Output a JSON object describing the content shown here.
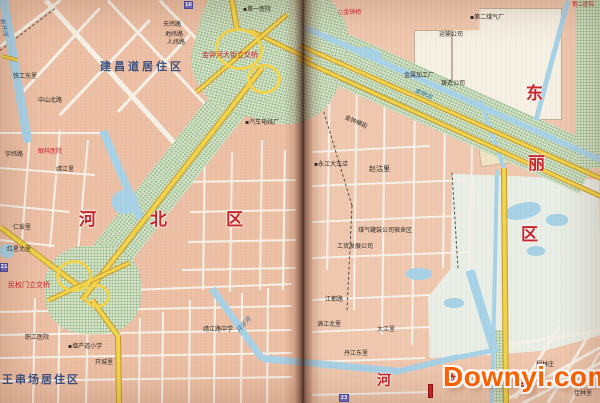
{
  "meta": {
    "description": "Scanned two-page atlas spread of a Tianjin city map showing Hebei District, Dongli District and Hedong District with Jinzhonghe Street interchanges, canals and residential areas",
    "watermark": {
      "text": "Downyi.com"
    }
  },
  "palette": {
    "map_pink": "#edc0a5",
    "street_white": "#f7f2e9",
    "water_blue": "#a9d2e6",
    "highway_yellow": "#f1d44e",
    "highway_edge": "#c19a3a",
    "park_green": "#d6e3ca",
    "park_green_dot": "#96bb8e",
    "district_red": "#c5232b",
    "residential_navy": "#3c5080",
    "label_ink": "#2f2b26",
    "water_label_blue": "#2b6b9c",
    "pale_field": "#e9efe6",
    "industrial_white": "#f6f1e4",
    "watermark_orange": "#ff6400",
    "marker_blue": "#6a6ac2",
    "marker_red": "#c5232b"
  },
  "shapes": {
    "under": [
      {
        "n": "pale-field-area",
        "x": 428,
        "y": 170,
        "w": 173,
        "h": 190,
        "cls": "pale",
        "clip": "polygon(14% 2%, 99% 5%, 100% 87%, 68% 95%, 42% 97%, 1% 99%, 0 67%, 13% 52%)"
      },
      {
        "n": "industrial-block-a",
        "x": 452,
        "y": 8,
        "w": 110,
        "h": 112,
        "cls": "white",
        "clip": "polygon(0 20%, 25% 20%, 25% 0, 100% 0, 100% 100%, 0 100%)"
      },
      {
        "n": "industrial-block-b",
        "x": 414,
        "y": 30,
        "w": 38,
        "h": 58,
        "cls": "white"
      },
      {
        "n": "industrial-block-c",
        "x": 478,
        "y": 126,
        "w": 50,
        "h": 38,
        "cls": "cream",
        "rot": -8
      }
    ],
    "streets": [
      [
        46,
        0,
        183,
        152,
        4.5
      ],
      [
        108,
        0,
        213,
        112,
        2.5
      ],
      [
        160,
        0,
        242,
        86,
        2.5
      ],
      [
        0,
        46,
        60,
        0,
        2.5
      ],
      [
        100,
        8,
        20,
        95,
        2.5
      ],
      [
        150,
        20,
        60,
        115,
        2.5
      ],
      [
        190,
        35,
        118,
        112,
        2.5
      ],
      [
        0,
        133,
        100,
        133,
        2
      ],
      [
        30,
        135,
        22,
        240,
        2
      ],
      [
        60,
        130,
        50,
        248,
        2
      ],
      [
        88,
        140,
        78,
        252,
        2
      ],
      [
        0,
        168,
        95,
        175,
        2
      ],
      [
        0,
        205,
        70,
        212,
        2
      ],
      [
        0,
        240,
        55,
        246,
        2
      ],
      [
        35,
        298,
        33,
        403,
        2
      ],
      [
        60,
        288,
        58,
        403,
        2
      ],
      [
        88,
        300,
        86,
        403,
        2
      ],
      [
        140,
        318,
        139,
        403,
        2
      ],
      [
        163,
        312,
        162,
        403,
        2
      ],
      [
        190,
        300,
        189,
        403,
        2
      ],
      [
        215,
        298,
        214,
        403,
        2
      ],
      [
        242,
        293,
        241,
        403,
        2
      ],
      [
        268,
        288,
        267,
        403,
        2
      ],
      [
        0,
        312,
        292,
        306,
        2
      ],
      [
        0,
        335,
        292,
        330,
        2
      ],
      [
        0,
        358,
        292,
        353,
        2
      ],
      [
        0,
        381,
        292,
        377,
        2
      ],
      [
        130,
        290,
        292,
        284,
        2
      ],
      [
        205,
        140,
        203,
        290,
        2
      ],
      [
        232,
        152,
        230,
        292,
        2
      ],
      [
        262,
        140,
        260,
        290,
        2
      ],
      [
        285,
        150,
        283,
        290,
        2
      ],
      [
        185,
        182,
        296,
        180,
        2
      ],
      [
        190,
        212,
        296,
        210,
        2
      ],
      [
        188,
        242,
        296,
        240,
        2
      ],
      [
        182,
        270,
        296,
        268,
        2
      ],
      [
        330,
        62,
        327,
        270,
        2
      ],
      [
        357,
        68,
        354,
        310,
        2
      ],
      [
        385,
        75,
        382,
        335,
        2
      ],
      [
        415,
        98,
        412,
        345,
        2
      ],
      [
        445,
        122,
        443,
        268,
        2
      ],
      [
        472,
        145,
        470,
        268,
        2
      ],
      [
        312,
        152,
        430,
        146,
        2
      ],
      [
        312,
        186,
        468,
        180,
        2
      ],
      [
        312,
        222,
        455,
        216,
        2
      ],
      [
        312,
        258,
        470,
        252,
        2
      ],
      [
        312,
        300,
        430,
        295,
        2
      ],
      [
        312,
        332,
        430,
        327,
        2
      ],
      [
        312,
        362,
        425,
        358,
        2
      ],
      [
        312,
        395,
        430,
        392,
        2
      ],
      [
        505,
        400,
        600,
        347,
        3
      ],
      [
        522,
        403,
        601,
        362,
        2.5
      ],
      [
        505,
        345,
        600,
        330,
        2.5
      ],
      [
        560,
        325,
        515,
        398,
        2.5
      ],
      [
        592,
        330,
        548,
        403,
        2.5
      ],
      [
        600,
        352,
        570,
        403,
        2
      ]
    ],
    "dashes": [
      [
        0,
        50,
        55,
        8,
        1
      ],
      [
        318,
        92,
        352,
        205,
        1
      ],
      [
        352,
        205,
        347,
        310,
        1
      ],
      [
        452,
        172,
        458,
        268,
        1
      ]
    ],
    "greens": [
      {
        "n": "greenbelt-jinzhonghe-street",
        "x": 62,
        "y": 285,
        "w": 300,
        "h": 40,
        "rot": -52,
        "origin": "0 0",
        "cls": "green"
      },
      {
        "n": "greenbelt-jinzhong-river",
        "x": 290,
        "y": 8,
        "w": 340,
        "h": 52,
        "rot": 24,
        "origin": "0 0",
        "cls": "green"
      },
      {
        "n": "interchange-park-north",
        "x": 195,
        "y": -20,
        "w": 150,
        "h": 140,
        "rot": 15,
        "br": "38%",
        "cls": "green"
      },
      {
        "n": "interchange-park-minquanmen",
        "x": 45,
        "y": 246,
        "w": 96,
        "h": 88,
        "br": "42%",
        "cls": "green"
      },
      {
        "n": "green-strip-east-edge",
        "x": 576,
        "y": 0,
        "w": 24,
        "h": 168,
        "cls": "green"
      },
      {
        "n": "green-strip-ring-road",
        "x": 492,
        "y": 330,
        "w": 12,
        "h": 73,
        "cls": "green"
      }
    ],
    "water_segs": [
      [
        3,
        -4,
        28,
        142,
        9
      ],
      [
        103,
        131,
        140,
        218,
        8
      ],
      [
        212,
        288,
        262,
        358,
        7
      ],
      [
        262,
        358,
        400,
        371,
        7
      ],
      [
        400,
        371,
        458,
        357,
        6
      ],
      [
        458,
        357,
        498,
        349,
        5
      ],
      [
        306,
        28,
        601,
        160,
        6
      ],
      [
        480,
        100,
        504,
        168,
        4
      ],
      [
        497,
        170,
        492,
        403,
        4
      ],
      [
        470,
        270,
        495,
        352,
        9
      ],
      [
        568,
        0,
        536,
        120,
        5
      ]
    ],
    "water_blobs": [
      {
        "n": "pond",
        "x": 505,
        "y": 203,
        "w": 36,
        "h": 16,
        "br": "45%",
        "rot": -12
      },
      {
        "n": "pond",
        "x": 546,
        "y": 214,
        "w": 22,
        "h": 12,
        "br": "45%"
      },
      {
        "n": "pond",
        "x": 527,
        "y": 246,
        "w": 18,
        "h": 10,
        "br": "45%"
      },
      {
        "n": "pond",
        "x": 406,
        "y": 268,
        "w": 26,
        "h": 12,
        "br": "45%"
      },
      {
        "n": "pond",
        "x": 444,
        "y": 298,
        "w": 20,
        "h": 10,
        "br": "45%"
      },
      {
        "n": "pond",
        "x": 0,
        "y": 244,
        "w": 14,
        "h": 14,
        "br": "40%"
      },
      {
        "n": "pond",
        "x": 356,
        "y": 48,
        "w": 26,
        "h": 11,
        "br": "45%",
        "rot": 15
      },
      {
        "n": "pond",
        "x": 112,
        "y": 190,
        "w": 26,
        "h": 24,
        "br": "45%"
      }
    ],
    "highways": [
      [
        82,
        300,
        262,
        68,
        6
      ],
      [
        237,
        30,
        231,
        -6,
        6
      ],
      [
        250,
        30,
        312,
        60,
        5
      ],
      [
        300,
        45,
        601,
        178,
        5
      ],
      [
        298,
        58,
        601,
        196,
        5
      ],
      [
        504,
        168,
        506,
        403,
        6
      ],
      [
        92,
        300,
        118,
        336,
        6
      ],
      [
        118,
        336,
        119,
        403,
        6
      ],
      [
        80,
        287,
        0,
        227,
        6
      ],
      [
        2,
        56,
        17,
        60,
        4
      ],
      [
        196,
        92,
        287,
        14,
        5
      ],
      [
        48,
        300,
        130,
        262,
        5
      ]
    ],
    "rings": [
      {
        "n": "interchange-ramp-loop",
        "x": 215,
        "y": 28,
        "w": 48,
        "h": 42,
        "br": "50%",
        "rot": 10,
        "cls": "ring"
      },
      {
        "n": "interchange-ramp-loop",
        "x": 247,
        "y": 64,
        "w": 34,
        "h": 30,
        "br": "50%",
        "cls": "ring"
      },
      {
        "n": "interchange-ramp-loop",
        "x": 56,
        "y": 260,
        "w": 36,
        "h": 32,
        "br": "50%",
        "cls": "ring"
      },
      {
        "n": "interchange-ramp-loop",
        "x": 84,
        "y": 284,
        "w": 26,
        "h": 24,
        "br": "50%",
        "cls": "ring"
      }
    ]
  },
  "markers": [
    {
      "n": "grid-marker-top",
      "x": 184,
      "y": 1,
      "w": 9,
      "h": 8,
      "t": "16",
      "cls": "m-blue"
    },
    {
      "n": "grid-marker-left",
      "x": 0,
      "y": 263,
      "w": 8,
      "h": 9,
      "t": "21",
      "cls": "m-blue"
    },
    {
      "n": "grid-marker-bottom",
      "x": 339,
      "y": 394,
      "w": 10,
      "h": 8,
      "t": "23",
      "cls": "m-blue"
    },
    {
      "n": "red-building-marker",
      "x": 428,
      "y": 384,
      "w": 5,
      "h": 14,
      "t": "",
      "cls": "m-red"
    }
  ],
  "labels": {
    "district": [
      {
        "t": "河",
        "x": 79,
        "y": 212,
        "s": 17
      },
      {
        "t": "北",
        "x": 150,
        "y": 212,
        "s": 17
      },
      {
        "t": "区",
        "x": 226,
        "y": 212,
        "s": 17
      },
      {
        "t": "东",
        "x": 526,
        "y": 86,
        "s": 17
      },
      {
        "t": "丽",
        "x": 528,
        "y": 156,
        "s": 17
      },
      {
        "t": "区",
        "x": 521,
        "y": 227,
        "s": 17
      },
      {
        "t": "河",
        "x": 377,
        "y": 374,
        "s": 14
      },
      {
        "t": "东",
        "x": 446,
        "y": 375,
        "s": 14
      },
      {
        "t": "区",
        "x": 518,
        "y": 375,
        "s": 14
      }
    ],
    "residential": [
      {
        "t": "建昌道居住区",
        "x": 100,
        "y": 61,
        "s": 11,
        "ls": 3
      },
      {
        "t": "王串场居住区",
        "x": 2,
        "y": 374,
        "s": 11,
        "ls": 2
      }
    ],
    "red": [
      {
        "t": "金钟河大街立交桥",
        "x": 202,
        "y": 52,
        "s": 7
      },
      {
        "t": "民权门立交桥",
        "x": 8,
        "y": 282,
        "s": 7
      },
      {
        "t": "○金钟桥",
        "x": 338,
        "y": 10,
        "s": 6
      },
      {
        "t": "眼科医院",
        "x": 38,
        "y": 149,
        "s": 6
      },
      {
        "t": "第二医院",
        "x": 572,
        "y": 3,
        "s": 5.5
      }
    ],
    "blue": [
      {
        "t": "月牙河",
        "x": 236,
        "y": 330,
        "s": 6,
        "rot": -48
      },
      {
        "t": "金钟河",
        "x": 416,
        "y": 88,
        "s": 6,
        "rot": 25
      },
      {
        "t": "新开河",
        "x": 4,
        "y": 18,
        "s": 6,
        "rot": 78
      }
    ],
    "small": [
      {
        "t": "▪第一医院",
        "x": 243,
        "y": 7,
        "s": 6
      },
      {
        "t": "天纬路",
        "x": 163,
        "y": 22,
        "s": 6
      },
      {
        "t": "地纬路",
        "x": 165,
        "y": 32,
        "s": 6
      },
      {
        "t": "人纬路",
        "x": 167,
        "y": 40,
        "s": 6
      },
      {
        "t": "铁工东里",
        "x": 13,
        "y": 74,
        "s": 6
      },
      {
        "t": "中山北路",
        "x": 38,
        "y": 98,
        "s": 6
      },
      {
        "t": "▪汽车电线厂",
        "x": 245,
        "y": 120,
        "s": 6
      },
      {
        "t": "靖江里",
        "x": 56,
        "y": 167,
        "s": 6
      },
      {
        "t": "仁爱里",
        "x": 13,
        "y": 225,
        "s": 6
      },
      {
        "t": "红星北里",
        "x": 7,
        "y": 247,
        "s": 6
      },
      {
        "t": "职工医院",
        "x": 25,
        "y": 335,
        "s": 6
      },
      {
        "t": "▪增产道小学",
        "x": 68,
        "y": 344,
        "s": 6
      },
      {
        "t": "开城里",
        "x": 95,
        "y": 360,
        "s": 6
      },
      {
        "t": "宇纬路",
        "x": 5,
        "y": 152,
        "s": 6
      },
      {
        "t": "靖江路中学",
        "x": 203,
        "y": 327,
        "s": 6
      },
      {
        "t": "▪第二煤气厂",
        "x": 470,
        "y": 15,
        "s": 6
      },
      {
        "t": "运输公司",
        "x": 439,
        "y": 32,
        "s": 6
      },
      {
        "t": "金属加工厂",
        "x": 404,
        "y": 73,
        "s": 6
      },
      {
        "t": "铸造公司",
        "x": 441,
        "y": 81,
        "s": 6
      },
      {
        "t": "赵沽里",
        "x": 369,
        "y": 166,
        "s": 7
      },
      {
        "t": "▪永江大车店",
        "x": 314,
        "y": 162,
        "s": 6
      },
      {
        "t": "煤气罐装公司宿舍区",
        "x": 358,
        "y": 228,
        "s": 6
      },
      {
        "t": "工贸发展公司",
        "x": 337,
        "y": 244,
        "s": 6
      },
      {
        "t": "满江北里",
        "x": 317,
        "y": 322,
        "s": 6
      },
      {
        "t": "大江里",
        "x": 377,
        "y": 327,
        "s": 6
      },
      {
        "t": "丹江东里",
        "x": 344,
        "y": 351,
        "s": 6
      },
      {
        "t": "江都路",
        "x": 325,
        "y": 297,
        "s": 6
      },
      {
        "t": "金钟横街",
        "x": 346,
        "y": 115,
        "s": 6,
        "rot": 24
      },
      {
        "t": "程林庄",
        "x": 536,
        "y": 362,
        "s": 6
      },
      {
        "t": "佳林里",
        "x": 574,
        "y": 391,
        "s": 6
      }
    ]
  }
}
